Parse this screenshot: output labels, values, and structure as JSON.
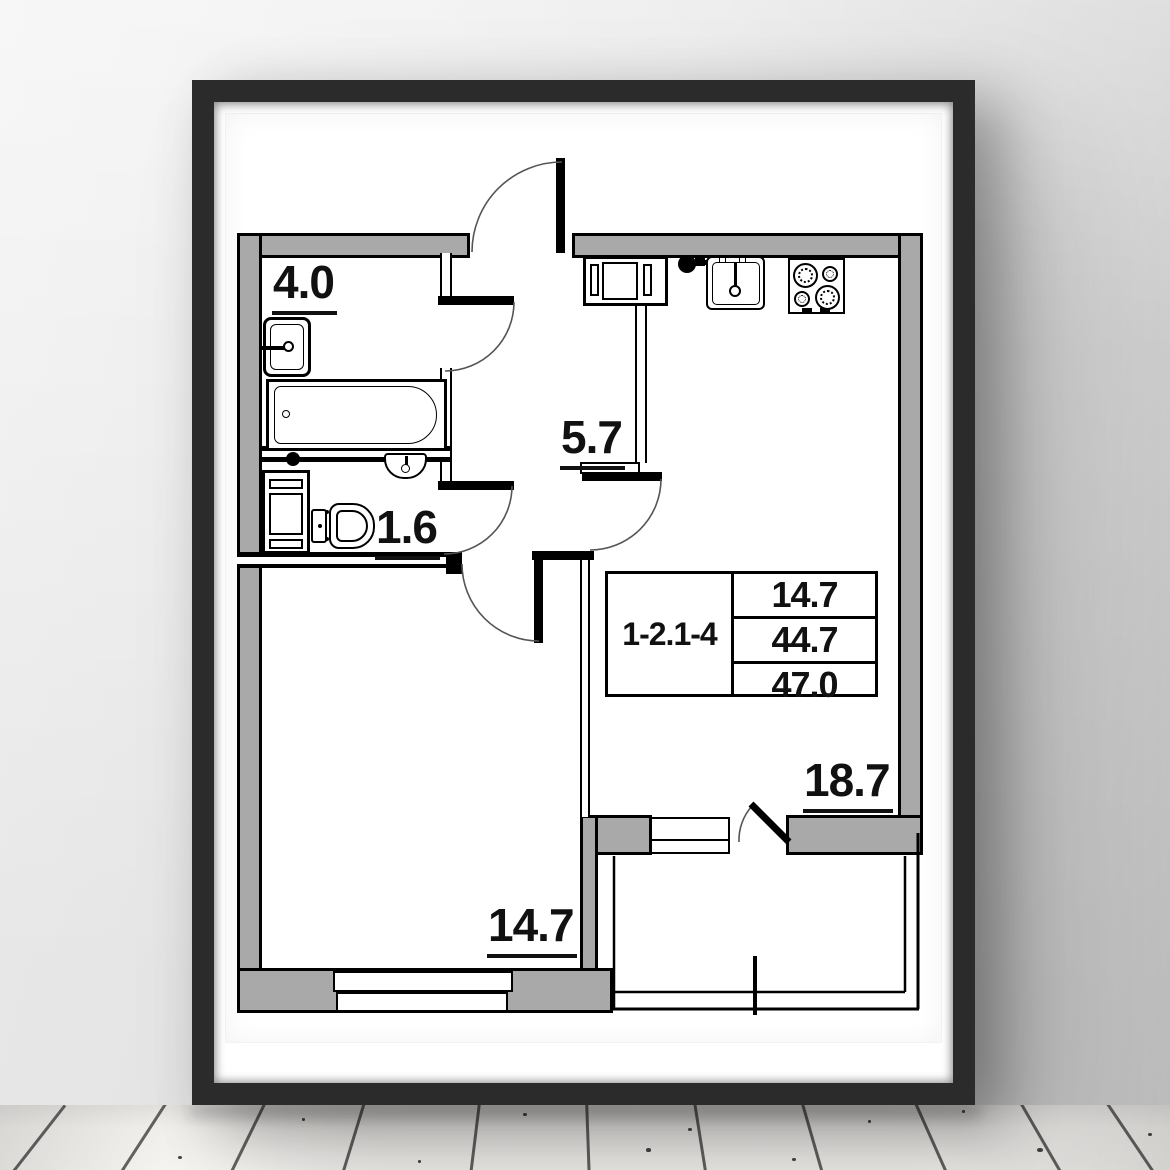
{
  "scene": {
    "description": "Framed apartment floor plan poster hanging on a wall above a whitewashed wooden plank floor"
  },
  "plan": {
    "unit_id": "1-2.1-4",
    "summary": {
      "values": [
        "14.7",
        "44.7",
        "47.0"
      ]
    },
    "rooms": {
      "bathroom": {
        "area": "4.0"
      },
      "toilet": {
        "area": "1.6"
      },
      "hallway": {
        "area": "5.7"
      },
      "kitchen_living": {
        "area": "18.7"
      },
      "room": {
        "area": "14.7"
      }
    },
    "fixtures": [
      "bathtub",
      "wash-basin",
      "toilet",
      "washing-machine",
      "small-sink",
      "kitchen-sink",
      "stove",
      "kitchen-cabinet"
    ],
    "colors": {
      "wall_fill": "#a9a9a9",
      "line": "#000000",
      "frame": "#2b2b2b",
      "paper": "#ffffff"
    }
  }
}
